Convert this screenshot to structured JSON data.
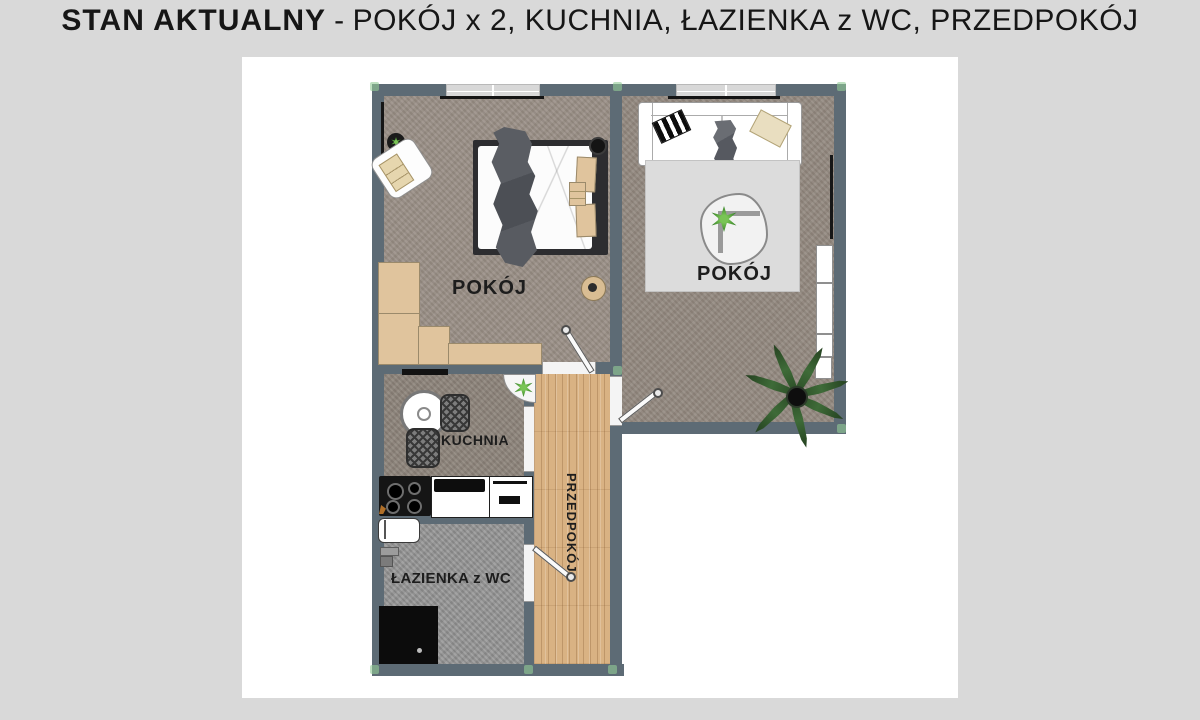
{
  "title": {
    "bold": "STAN AKTUALNY",
    "separator": "-",
    "rest": "POKÓJ x 2, KUCHNIA, ŁAZIENKA z WC, PRZEDPOKÓJ"
  },
  "rooms": {
    "bedroom": {
      "label": "POKÓJ"
    },
    "living": {
      "label": "POKÓJ"
    },
    "kitchen": {
      "label": "KUCHNIA"
    },
    "bathroom": {
      "label": "ŁAZIENKA z WC"
    },
    "hallway": {
      "label": "PRZEDPOKÓJ"
    }
  },
  "palette": {
    "background": "#d9d9d9",
    "panel": "#ffffff",
    "wall": "#5d6b75",
    "floor_taupe": "#9a9087",
    "floor_taupe_dark": "#8e857c",
    "floor_bath": "#969696",
    "floor_wood": "#d9b283",
    "furniture_beige": "#e0c49d",
    "rug": "#dcdcdc",
    "accent_green": "#3e8f35",
    "corner_marker": "#92cc96",
    "text": "#1d1d1d"
  }
}
